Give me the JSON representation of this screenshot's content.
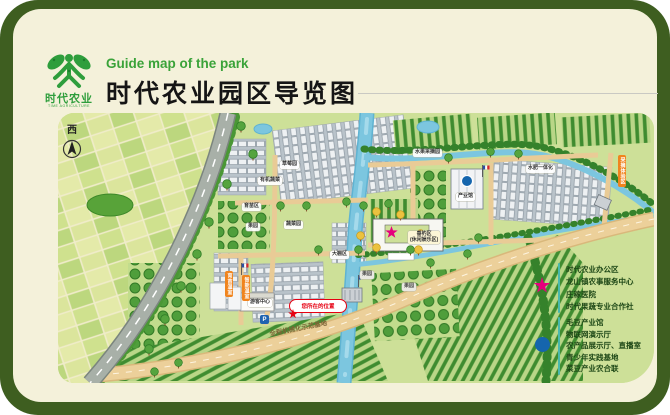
{
  "header": {
    "logo_cn": "时代农业",
    "logo_en": "TIME AGRICULTURE",
    "subtitle_en": "Guide map of the park",
    "title_cn": "时代农业园区导览图"
  },
  "map": {
    "compass": "西",
    "road_text": "全程机械化示范基地",
    "you_are_here": "您所在的位置",
    "parking": "P",
    "tags": [
      {
        "text": "草莓园",
        "x": 222,
        "y": 48,
        "kind": "white"
      },
      {
        "text": "有机蔬菜",
        "x": 200,
        "y": 64,
        "kind": "white"
      },
      {
        "text": "育苗区",
        "x": 184,
        "y": 90,
        "kind": "white"
      },
      {
        "text": "蔬菜园",
        "x": 226,
        "y": 108,
        "kind": "white"
      },
      {
        "text": "果园",
        "x": 188,
        "y": 110,
        "kind": "white"
      },
      {
        "text": "大棚区",
        "x": 272,
        "y": 138,
        "kind": "white"
      },
      {
        "text": "垂钓区\n(休闲娱乐区)",
        "x": 350,
        "y": 118,
        "kind": "yellow"
      },
      {
        "text": "果园",
        "x": 302,
        "y": 158,
        "kind": "gray"
      },
      {
        "text": "果园",
        "x": 344,
        "y": 170,
        "kind": "gray"
      },
      {
        "text": "产业馆",
        "x": 398,
        "y": 80,
        "kind": "white"
      },
      {
        "text": "游客中心",
        "x": 190,
        "y": 186,
        "kind": "white"
      },
      {
        "text": "水果采摘园",
        "x": 355,
        "y": 36,
        "kind": "white"
      },
      {
        "text": "水肥一体化",
        "x": 468,
        "y": 52,
        "kind": "white"
      },
      {
        "text": "育苗温室",
        "x": 167,
        "y": 158,
        "kind": "vert"
      },
      {
        "text": "智能温室",
        "x": 184,
        "y": 162,
        "kind": "vert"
      },
      {
        "text": "采摘体验区",
        "x": 560,
        "y": 42,
        "kind": "vert"
      }
    ]
  },
  "legend": {
    "star_color": "#e5007d",
    "dot_color": "#1565ad",
    "star_items": [
      "时代农业办公区",
      "龙山镇农事服务中心",
      "庄稼医院",
      "时代果蔬专业合作社"
    ],
    "dot_items": [
      "毛豆产业馆",
      "物联网演示厅",
      "农产品展示厅、直播室",
      "青少年实践基地",
      "菜豆产业农合联"
    ]
  },
  "colors": {
    "frame": "#3e5e20",
    "card": "#f4f1da",
    "panel": "#cde098",
    "river": "#7cc6df",
    "road_tan": "#ecd09a",
    "highway": "#a8b0a8",
    "accent_green": "#3aa339"
  }
}
